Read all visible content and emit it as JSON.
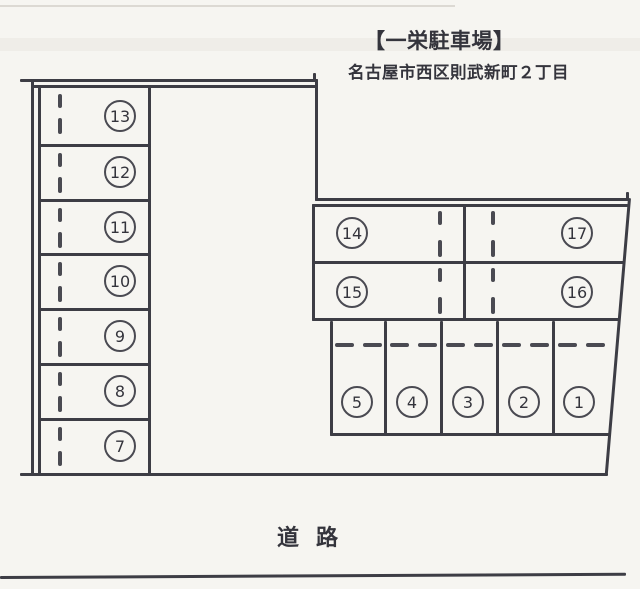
{
  "header": {
    "title": "【一栄駐車場】",
    "address": "名古屋市西区則武新町２丁目"
  },
  "road_label": "道路",
  "lot": {
    "left_column": [
      "13",
      "12",
      "11",
      "10",
      "9",
      "8",
      "7"
    ],
    "upper_right": [
      [
        "14",
        "17"
      ],
      [
        "15",
        "16"
      ]
    ],
    "bottom_row": [
      "5",
      "4",
      "3",
      "2",
      "1"
    ]
  },
  "colors": {
    "ink": "#3d3d45",
    "paper": "#f6f5f1"
  }
}
